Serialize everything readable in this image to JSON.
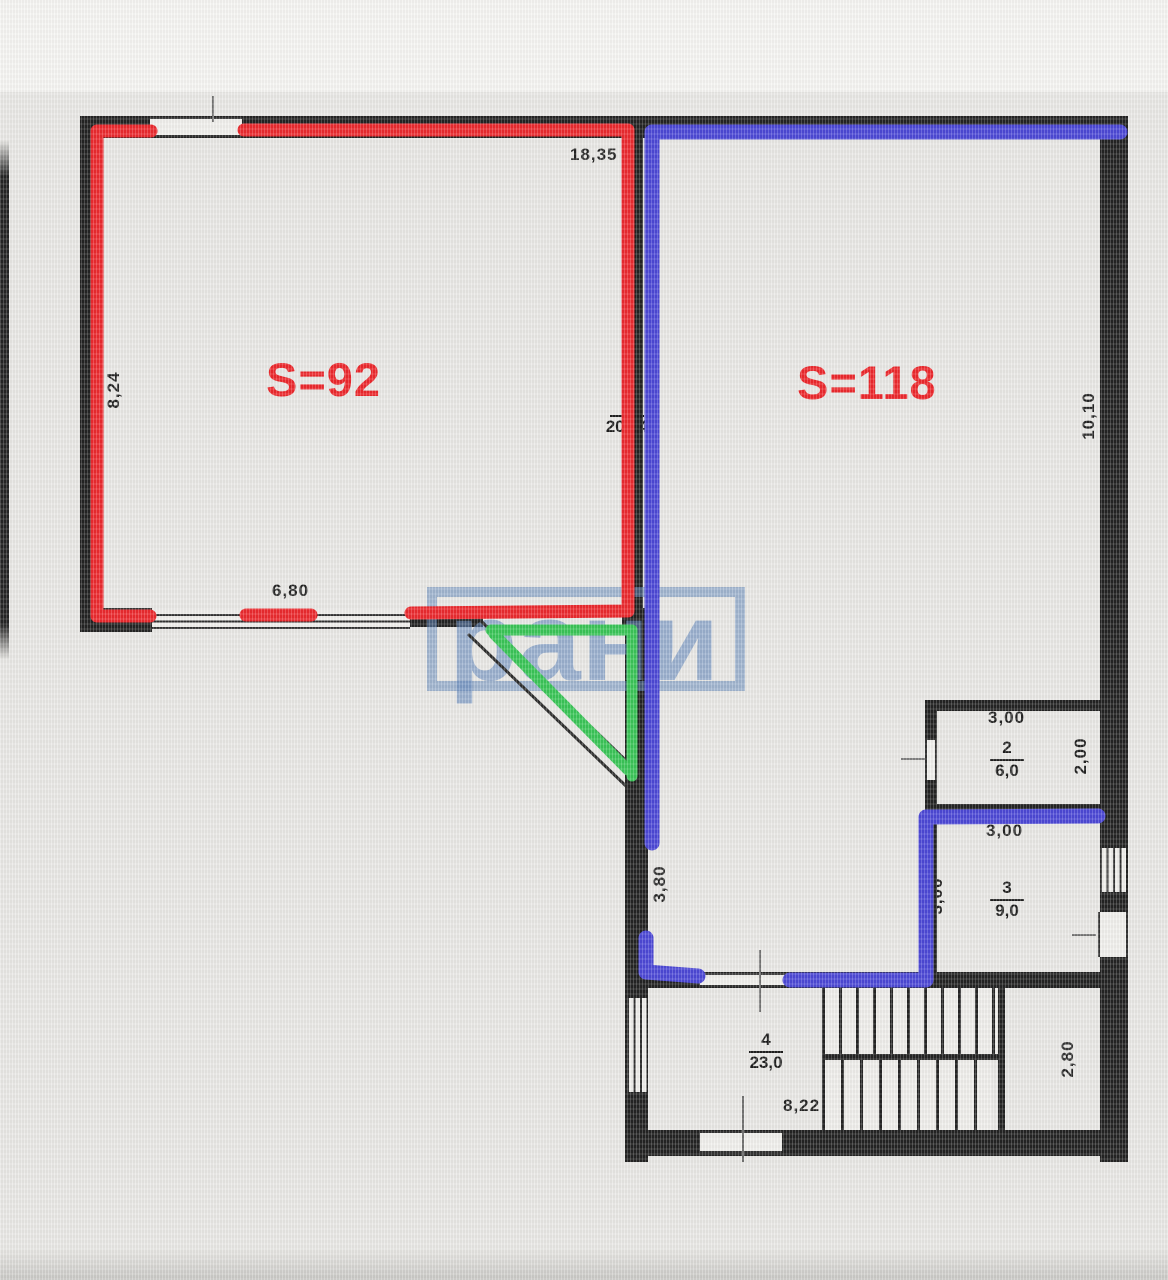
{
  "watermark": {
    "text": "рани"
  },
  "areas": {
    "s92": "S=92",
    "s118": "S=118"
  },
  "rooms": {
    "r1": {
      "num": "1",
      "area": "200,4"
    },
    "r2": {
      "num": "2",
      "area": "6,0"
    },
    "r3": {
      "num": "3",
      "area": "9,0"
    },
    "r4": {
      "num": "4",
      "area": "23,0"
    }
  },
  "dims": {
    "top": "18,35",
    "left": "8,24",
    "s92_bottom": "6,80",
    "right": "10,10",
    "r2_top": "3,00",
    "r2_right": "2,00",
    "r3_top": "3,00",
    "r3_left": "3,00",
    "hall": "3,80",
    "bottom": "8,22",
    "stairs_right": "2,80"
  },
  "colors": {
    "red": "#ec2227",
    "blue": "#4642d6",
    "green": "#33c452",
    "wall": "#1b1b1b",
    "watermark": "#5f85bc"
  }
}
